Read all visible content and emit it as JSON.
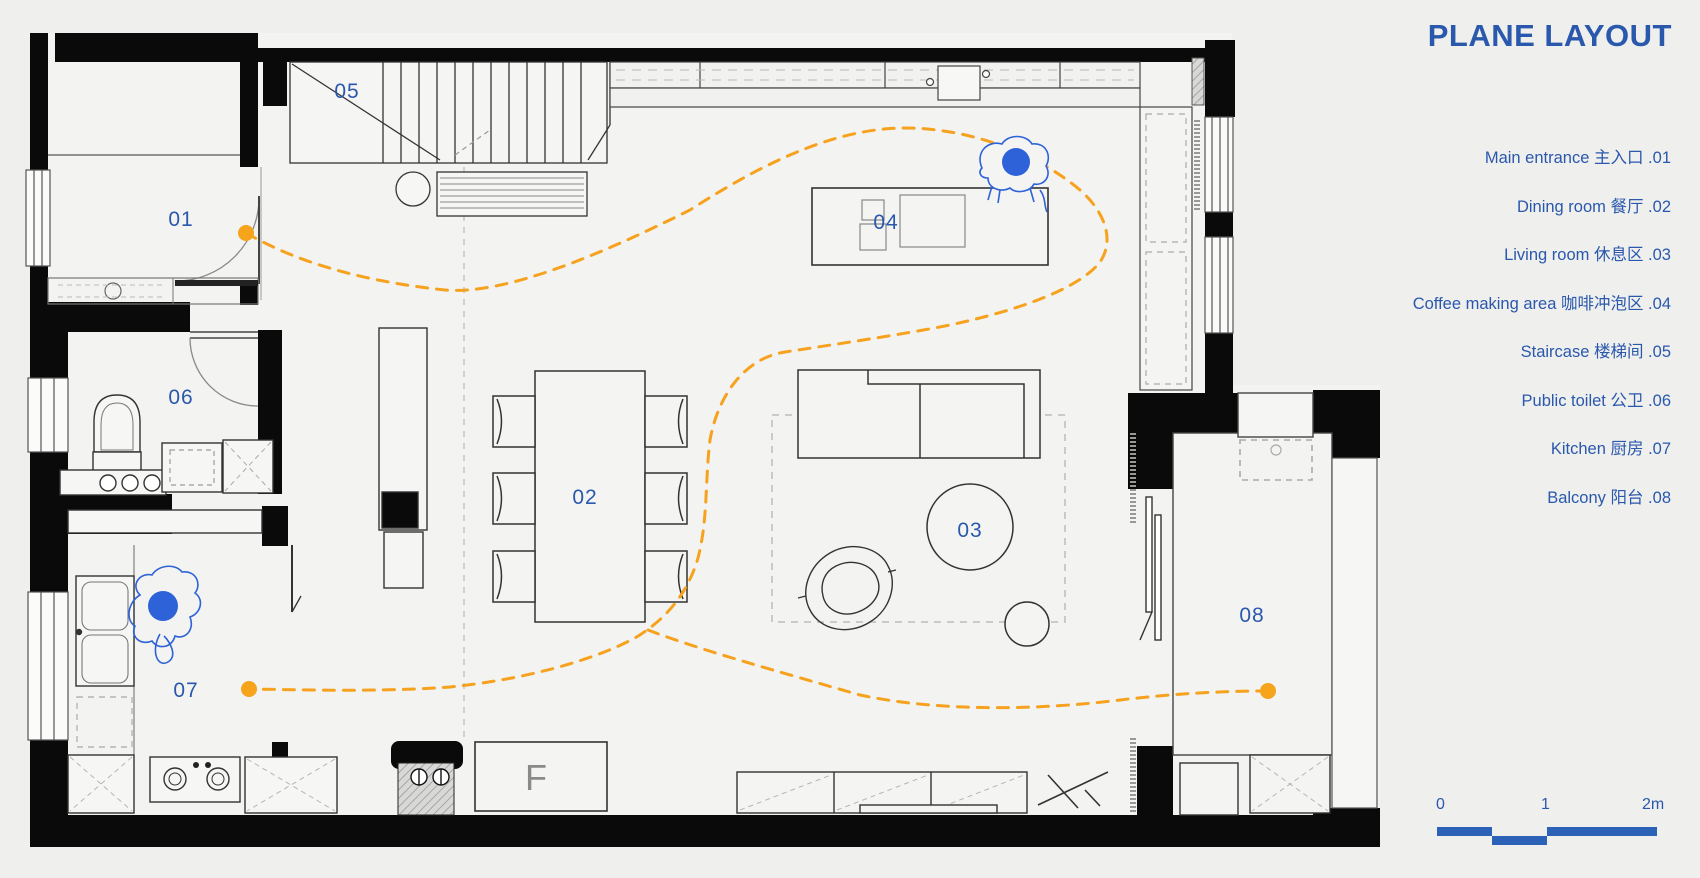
{
  "title": "PLANE LAYOUT",
  "legend": {
    "items": [
      {
        "label": "Main entrance 主入口 .01"
      },
      {
        "label": "Dining room 餐厅 .02"
      },
      {
        "label": "Living room 休息区 .03"
      },
      {
        "label": "Coffee making area 咖啡冲泡区 .04"
      },
      {
        "label": "Staircase 楼梯间 .05"
      },
      {
        "label": "Public toilet 公卫 .06"
      },
      {
        "label": "Kitchen 厨房 .07"
      },
      {
        "label": "Balcony 阳台 .08"
      }
    ]
  },
  "plan": {
    "rooms": [
      {
        "num": "01"
      },
      {
        "num": "02"
      },
      {
        "num": "03"
      },
      {
        "num": "04"
      },
      {
        "num": "05"
      },
      {
        "num": "06"
      },
      {
        "num": "07"
      },
      {
        "num": "08"
      }
    ],
    "fridge_label": "F"
  },
  "scale_bar": {
    "ticks": [
      "0",
      "1",
      "2m"
    ]
  },
  "colors": {
    "accent_blue": "#2a58ad",
    "path_orange": "#f6a21e",
    "wall_black": "#0a0a0a",
    "person_blue": "#2e62d8",
    "scalebar_blue": "#2b62b8",
    "background": "#efefed"
  }
}
